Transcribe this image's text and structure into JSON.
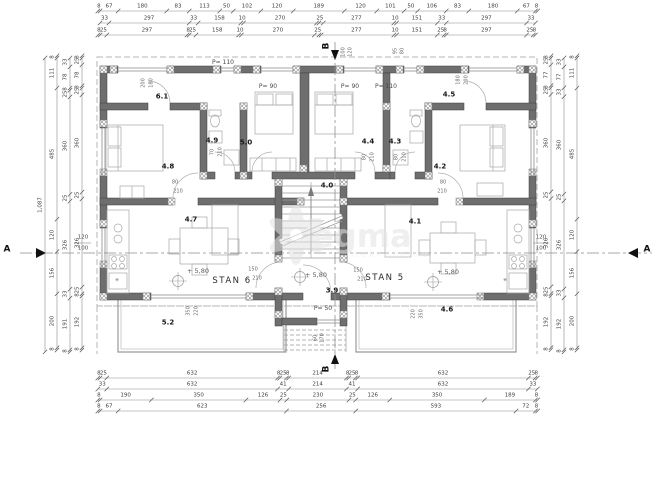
{
  "plan": {
    "stan_labels": [
      {
        "text": "STAN 6",
        "x": 232,
        "y": 281
      },
      {
        "text": "STAN 5",
        "x": 385,
        "y": 278
      }
    ],
    "total_height_dim": "1,087",
    "elevation_marks": [
      {
        "text": "+ 5,80",
        "x": 198,
        "y": 271
      },
      {
        "text": "+ 5,80",
        "x": 316,
        "y": 275
      },
      {
        "text": "+ 5,80",
        "x": 448,
        "y": 272
      }
    ]
  },
  "rooms": [
    {
      "text": "6.1",
      "x": 162,
      "y": 97
    },
    {
      "text": "4.9",
      "x": 212,
      "y": 141
    },
    {
      "text": "5.0",
      "x": 246,
      "y": 143
    },
    {
      "text": "4.8",
      "x": 168,
      "y": 167
    },
    {
      "text": "4.7",
      "x": 191,
      "y": 220
    },
    {
      "text": "4.4",
      "x": 368,
      "y": 142
    },
    {
      "text": "4.3",
      "x": 395,
      "y": 142
    },
    {
      "text": "4.5",
      "x": 449,
      "y": 95
    },
    {
      "text": "4.2",
      "x": 440,
      "y": 167
    },
    {
      "text": "4.1",
      "x": 415,
      "y": 222
    },
    {
      "text": "4.0",
      "x": 327,
      "y": 186
    },
    {
      "text": "3.9",
      "x": 332,
      "y": 291
    },
    {
      "text": "5.2",
      "x": 168,
      "y": 323
    },
    {
      "text": "4.6",
      "x": 447,
      "y": 310
    }
  ],
  "window_labels": [
    {
      "text": "P= 110",
      "x": 223,
      "y": 63
    },
    {
      "text": "P= 90",
      "x": 268,
      "y": 87
    },
    {
      "text": "P= 90",
      "x": 350,
      "y": 87
    },
    {
      "text": "P= 110",
      "x": 386,
      "y": 87
    },
    {
      "text": "P= 50",
      "x": 323,
      "y": 309
    }
  ],
  "section_markers": [
    {
      "text": "A",
      "x": 7,
      "y": 250,
      "rot": 0
    },
    {
      "text": "A",
      "x": 647,
      "y": 250,
      "rot": 0
    },
    {
      "text": "B",
      "x": 327,
      "y": 46,
      "rot": -90
    },
    {
      "text": "B",
      "x": 327,
      "y": 369,
      "rot": -90
    }
  ],
  "fractions": [
    {
      "top": "120",
      "bottom": "100",
      "x": 83,
      "y": 243
    },
    {
      "top": "120",
      "bottom": "100",
      "x": 541,
      "y": 243
    }
  ],
  "annotations": [
    {
      "text": "200",
      "x": 144,
      "y": 83,
      "rot": -90
    },
    {
      "text": "180",
      "x": 152,
      "y": 83,
      "rot": -90
    },
    {
      "text": "180",
      "x": 459,
      "y": 80,
      "rot": -90
    },
    {
      "text": "200",
      "x": 467,
      "y": 80,
      "rot": -90
    },
    {
      "text": "100",
      "x": 344,
      "y": 52,
      "rot": -90
    },
    {
      "text": "120",
      "x": 351,
      "y": 52,
      "rot": -90
    },
    {
      "text": "95",
      "x": 396,
      "y": 51,
      "rot": -90
    },
    {
      "text": "80",
      "x": 403,
      "y": 51,
      "rot": -90
    },
    {
      "text": "70",
      "x": 213,
      "y": 152,
      "rot": -90
    },
    {
      "text": "210",
      "x": 221,
      "y": 152,
      "rot": -90
    },
    {
      "text": "80",
      "x": 365,
      "y": 157,
      "rot": -90
    },
    {
      "text": "210",
      "x": 373,
      "y": 157,
      "rot": -90
    },
    {
      "text": "80",
      "x": 397,
      "y": 157,
      "rot": -90
    },
    {
      "text": "210",
      "x": 405,
      "y": 157,
      "rot": -90
    },
    {
      "text": "80",
      "x": 175,
      "y": 183,
      "rot": 0
    },
    {
      "text": "210",
      "x": 178,
      "y": 192,
      "rot": 0
    },
    {
      "text": "80",
      "x": 443,
      "y": 183,
      "rot": 0
    },
    {
      "text": "210",
      "x": 442,
      "y": 192,
      "rot": 0
    },
    {
      "text": "150",
      "x": 253,
      "y": 270,
      "rot": 0
    },
    {
      "text": "210",
      "x": 257,
      "y": 279,
      "rot": 0
    },
    {
      "text": "150",
      "x": 358,
      "y": 271,
      "rot": 0
    },
    {
      "text": "210",
      "x": 362,
      "y": 280,
      "rot": 0
    },
    {
      "text": "350",
      "x": 189,
      "y": 311,
      "rot": -90
    },
    {
      "text": "220",
      "x": 197,
      "y": 311,
      "rot": -90
    },
    {
      "text": "220",
      "x": 414,
      "y": 314,
      "rot": -90
    },
    {
      "text": "350",
      "x": 422,
      "y": 314,
      "rot": -90
    },
    {
      "text": "60",
      "x": 316,
      "y": 338,
      "rot": -90
    },
    {
      "text": "170",
      "x": 323,
      "y": 338,
      "rot": -90
    },
    {
      "text": "✳",
      "x": 117,
      "y": 281,
      "rot": 0
    },
    {
      "text": "✳",
      "x": 505,
      "y": 281,
      "rot": 0
    }
  ],
  "dim_rows": [
    {
      "y": 11,
      "groups": [
        {
          "start": -8,
          "values": [
            "8",
            "67",
            "180",
            "83",
            "113",
            "50",
            "102",
            "120",
            "189",
            "120",
            "101",
            "50",
            "106",
            "83",
            "180",
            "67",
            "8"
          ]
        }
      ]
    },
    {
      "y": 23,
      "groups": [
        {
          "start": 0,
          "values": [
            "33",
            "297",
            "33",
            "158",
            "10",
            "270",
            "25"
          ]
        },
        {
          "start": 810,
          "values": [
            "277",
            "10",
            "151",
            "33",
            "297",
            "33"
          ]
        }
      ]
    },
    {
      "y": 35,
      "groups": [
        {
          "start": -8,
          "values": [
            "8",
            "25",
            "297",
            "8",
            "25",
            "158",
            "10",
            "270",
            "25"
          ]
        },
        {
          "start": 810,
          "values": [
            "277",
            "10",
            "151",
            "25",
            "8",
            "297",
            "25",
            "8"
          ]
        }
      ]
    },
    {
      "y": 378,
      "groups": [
        {
          "start": -8,
          "values": [
            "8",
            "25",
            "632",
            "8",
            "25",
            "8",
            "214",
            "8",
            "25",
            "8",
            "632",
            "25",
            "8"
          ]
        }
      ]
    },
    {
      "y": 389,
      "groups": [
        {
          "start": -8,
          "values": [
            "33",
            "632",
            "41",
            "214",
            "41",
            "632",
            "33"
          ]
        }
      ]
    },
    {
      "y": 400,
      "groups": [
        {
          "start": -8,
          "values": [
            "8",
            "190",
            "350",
            "126",
            "25",
            "230",
            "25",
            "126",
            "350",
            "189",
            "8"
          ]
        }
      ]
    },
    {
      "y": 411,
      "groups": [
        {
          "start": -8,
          "values": [
            "8",
            "67",
            "623",
            "256",
            "593",
            "72",
            "8"
          ]
        }
      ]
    }
  ],
  "dim_cols": [
    {
      "x": 45,
      "groups": [
        {
          "start": 0,
          "values": [
            "1,087"
          ]
        }
      ]
    },
    {
      "x": 57,
      "groups": [
        {
          "start": -8,
          "values": [
            "8",
            "111",
            "485",
            "120",
            "156",
            "200",
            "8"
          ]
        }
      ]
    },
    {
      "x": 70,
      "groups": [
        {
          "start": 0,
          "values": [
            "33",
            "78",
            "8",
            "25",
            "360",
            "25",
            "326",
            "33",
            "191",
            "8"
          ]
        }
      ]
    },
    {
      "x": 82,
      "groups": [
        {
          "start": -8,
          "values": [
            "8",
            "25",
            "78",
            "8",
            "25",
            "360",
            "25",
            "326",
            "25",
            "8",
            "192",
            "8"
          ]
        }
      ]
    },
    {
      "x": 551,
      "groups": [
        {
          "start": -8,
          "values": [
            "8",
            "25",
            "77",
            "8",
            "25",
            "360",
            "25",
            "326",
            "25",
            "8",
            "192",
            "8"
          ]
        }
      ]
    },
    {
      "x": 564,
      "groups": [
        {
          "start": 0,
          "values": [
            "33",
            "77",
            "33",
            "360",
            "25",
            "326",
            "33",
            "192",
            "8"
          ]
        }
      ]
    },
    {
      "x": 577,
      "groups": [
        {
          "start": -8,
          "values": [
            "8",
            "111",
            "485",
            "120",
            "156",
            "200",
            "8"
          ]
        }
      ]
    }
  ],
  "watermark": {
    "word": "egma",
    "sub": "nekretnine"
  },
  "colors": {
    "wall": "#6e6e6e",
    "wall_edge": "#3f3f3f",
    "thin": "#a8a8a8",
    "dim": "#8a8a8a",
    "dash": "#b4b4b4",
    "watermark": "#e3e3e3"
  }
}
